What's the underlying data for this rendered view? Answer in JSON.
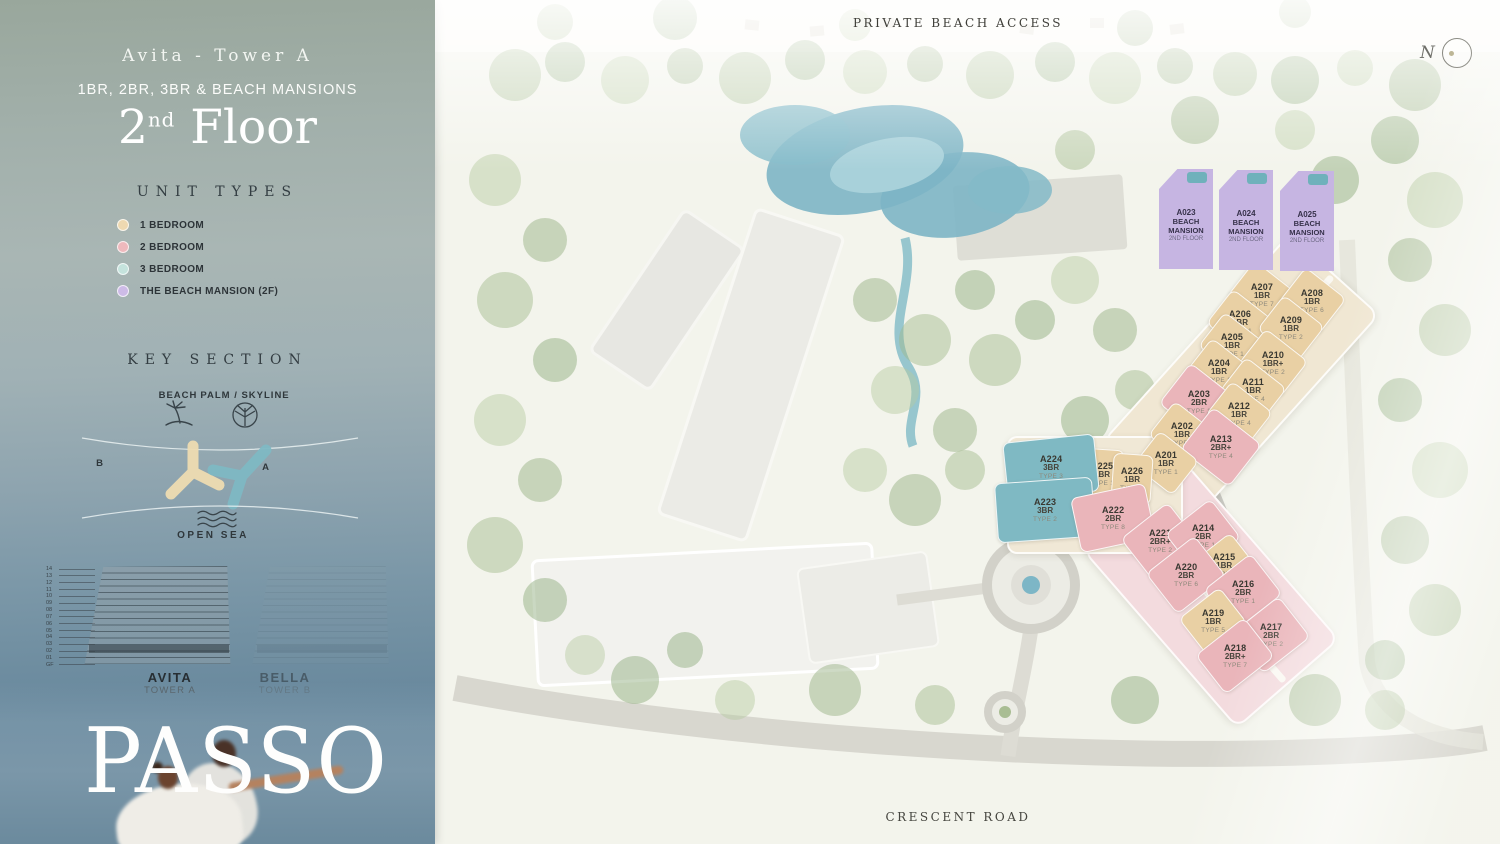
{
  "sidebar": {
    "tower_title": "Avita - Tower A",
    "subtitle": "1BR, 2BR, 3BR & BEACH MANSIONS",
    "floor_number": "2",
    "floor_suffix": "nd",
    "floor_word": "Floor",
    "unit_types_heading": "UNIT TYPES",
    "legend": [
      {
        "label": "1 BEDROOM",
        "color": "#eed9b1"
      },
      {
        "label": "2 BEDROOM",
        "color": "#eeb9bd"
      },
      {
        "label": "3 BEDROOM",
        "color": "#c5e3dd"
      },
      {
        "label": "THE BEACH MANSION (2F)",
        "color": "#cdbbe7"
      }
    ],
    "key_section": {
      "heading": "KEY SECTION",
      "beach_label": "BEACH",
      "palm_label": "PALM / SKYLINE",
      "tower_b_letter": "B",
      "tower_a_letter": "A",
      "open_sea_label": "OPEN SEA"
    },
    "elevations": {
      "floor_numbers": [
        "14",
        "13",
        "12",
        "11",
        "10",
        "09",
        "08",
        "07",
        "06",
        "05",
        "04",
        "03",
        "02",
        "01",
        "GF"
      ],
      "towers": [
        {
          "name": "AVITA",
          "sub": "TOWER A"
        },
        {
          "name": "BELLA",
          "sub": "TOWER B"
        }
      ]
    },
    "brand": "PASSO"
  },
  "map": {
    "top_label": "PRIVATE BEACH ACCESS",
    "bottom_label": "CRESCENT ROAD",
    "compass_label": "N",
    "colors": {
      "one_br": "#e9d0a4",
      "two_br": "#eab5ba",
      "three_br": "#7fb9c3",
      "mansion": "#c6b5e2"
    },
    "beach_mansions": [
      {
        "id": "A023",
        "line1": "BEACH",
        "line2": "MANSION",
        "floor": "2ND FLOOR",
        "x": 751,
        "y": 219
      },
      {
        "id": "A024",
        "line1": "BEACH",
        "line2": "MANSION",
        "floor": "2ND FLOOR",
        "x": 811,
        "y": 220
      },
      {
        "id": "A025",
        "line1": "BEACH",
        "line2": "MANSION",
        "floor": "2ND FLOOR",
        "x": 872,
        "y": 221
      }
    ],
    "units": [
      {
        "id": "A207",
        "br": "1BR",
        "type": "TYPE 7",
        "cat": "one_br",
        "x": 827,
        "y": 295,
        "w": 54,
        "h": 46,
        "rot": 38
      },
      {
        "id": "A208",
        "br": "1BR",
        "type": "TYPE 6",
        "cat": "one_br",
        "x": 877,
        "y": 301,
        "w": 52,
        "h": 46,
        "rot": 38
      },
      {
        "id": "A206",
        "br": "1BR",
        "type": "TYPE 1",
        "cat": "one_br",
        "x": 805,
        "y": 322,
        "w": 52,
        "h": 44,
        "rot": 38
      },
      {
        "id": "A209",
        "br": "1BR",
        "type": "TYPE 2",
        "cat": "one_br",
        "x": 856,
        "y": 328,
        "w": 52,
        "h": 44,
        "rot": 38
      },
      {
        "id": "A205",
        "br": "1BR",
        "type": "TYPE 1",
        "cat": "one_br",
        "x": 797,
        "y": 345,
        "w": 52,
        "h": 44,
        "rot": 38
      },
      {
        "id": "A210",
        "br": "1BR+",
        "type": "TYPE 2",
        "cat": "one_br",
        "x": 838,
        "y": 363,
        "w": 54,
        "h": 46,
        "rot": 38
      },
      {
        "id": "A204",
        "br": "1BR",
        "type": "TYPE 1",
        "cat": "one_br",
        "x": 784,
        "y": 371,
        "w": 52,
        "h": 44,
        "rot": 38
      },
      {
        "id": "A211",
        "br": "1BR",
        "type": "TYPE 4",
        "cat": "one_br",
        "x": 818,
        "y": 390,
        "w": 52,
        "h": 44,
        "rot": 38
      },
      {
        "id": "A203",
        "br": "2BR",
        "type": "TYPE 1",
        "cat": "two_br",
        "x": 764,
        "y": 402,
        "w": 62,
        "h": 52,
        "rot": 38
      },
      {
        "id": "A212",
        "br": "1BR",
        "type": "TYPE 4",
        "cat": "one_br",
        "x": 804,
        "y": 414,
        "w": 52,
        "h": 44,
        "rot": 38
      },
      {
        "id": "A202",
        "br": "1BR",
        "type": "TYPE 1",
        "cat": "one_br",
        "x": 747,
        "y": 434,
        "w": 52,
        "h": 44,
        "rot": 38
      },
      {
        "id": "A213",
        "br": "2BR+",
        "type": "TYPE 4",
        "cat": "two_br",
        "x": 786,
        "y": 447,
        "w": 62,
        "h": 54,
        "rot": 38
      },
      {
        "id": "A201",
        "br": "1BR",
        "type": "TYPE 1",
        "cat": "one_br",
        "x": 731,
        "y": 463,
        "w": 50,
        "h": 44,
        "rot": 38
      },
      {
        "id": "A225",
        "br": "1BR",
        "type": "TYPE 1",
        "cat": "one_br",
        "x": 667,
        "y": 474,
        "w": 42,
        "h": 50,
        "rot": 4
      },
      {
        "id": "A226",
        "br": "1BR",
        "type": "TYPE 1",
        "cat": "one_br",
        "x": 697,
        "y": 479,
        "w": 40,
        "h": 50,
        "rot": 4
      },
      {
        "id": "A224",
        "br": "3BR",
        "type": "TYPE 3",
        "cat": "three_br",
        "x": 616,
        "y": 467,
        "w": 92,
        "h": 58,
        "rot": -6
      },
      {
        "id": "A223",
        "br": "3BR",
        "type": "TYPE 2",
        "cat": "three_br",
        "x": 610,
        "y": 510,
        "w": 98,
        "h": 60,
        "rot": -4
      },
      {
        "id": "A222",
        "br": "2BR",
        "type": "TYPE 8",
        "cat": "two_br",
        "x": 678,
        "y": 518,
        "w": 76,
        "h": 56,
        "rot": -12
      },
      {
        "id": "A221",
        "br": "2BR+",
        "type": "TYPE 2",
        "cat": "two_br",
        "x": 725,
        "y": 541,
        "w": 60,
        "h": 52,
        "rot": -38
      },
      {
        "id": "A214",
        "br": "2BR",
        "type": "TYPE 1",
        "cat": "two_br",
        "x": 768,
        "y": 536,
        "w": 58,
        "h": 50,
        "rot": -38
      },
      {
        "id": "A215",
        "br": "1BR",
        "type": "TYPE 1",
        "cat": "one_br",
        "x": 789,
        "y": 565,
        "w": 50,
        "h": 44,
        "rot": -38
      },
      {
        "id": "A220",
        "br": "2BR",
        "type": "TYPE 6",
        "cat": "two_br",
        "x": 751,
        "y": 575,
        "w": 62,
        "h": 52,
        "rot": -38
      },
      {
        "id": "A216",
        "br": "2BR",
        "type": "TYPE 1",
        "cat": "two_br",
        "x": 808,
        "y": 592,
        "w": 60,
        "h": 52,
        "rot": -38
      },
      {
        "id": "A219",
        "br": "1BR",
        "type": "TYPE 5",
        "cat": "one_br",
        "x": 778,
        "y": 621,
        "w": 52,
        "h": 46,
        "rot": -38
      },
      {
        "id": "A217",
        "br": "2BR",
        "type": "TYPE 2",
        "cat": "two_br",
        "x": 836,
        "y": 635,
        "w": 60,
        "h": 52,
        "rot": -38
      },
      {
        "id": "A218",
        "br": "2BR+",
        "type": "TYPE 7",
        "cat": "two_br",
        "x": 800,
        "y": 656,
        "w": 62,
        "h": 50,
        "rot": -38
      }
    ]
  }
}
